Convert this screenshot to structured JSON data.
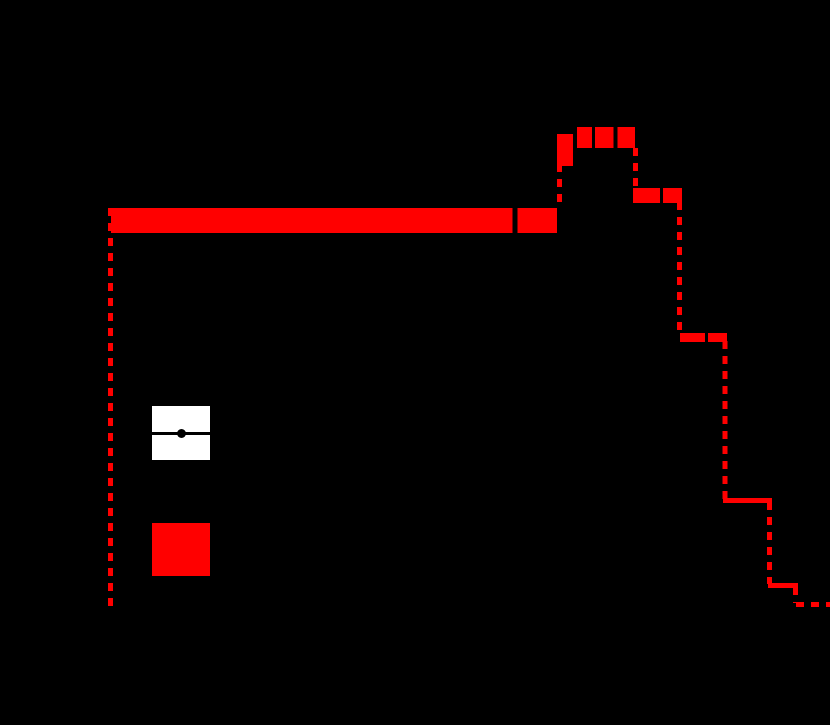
{
  "canvas": {
    "width_px": 830,
    "height_px": 725,
    "background_color": "#000000"
  },
  "palette": {
    "histogram_red": "#ff0000",
    "legend_patch_white": "#ffffff",
    "marker_black": "#000000"
  },
  "chart_data": {
    "type": "step-histogram-with-uncertainty-band",
    "title": "",
    "axes_visible": false,
    "tick_labels_visible": false,
    "legend_text_visible": false,
    "bin_edges_px": [
      110.5,
      557.5,
      577,
      635.5,
      679.5,
      725,
      769.5,
      795.5,
      832
    ],
    "bin_value_y_px": [
      220.5,
      150,
      137.5,
      195.5,
      337.5,
      500.5,
      585.5,
      604.5
    ],
    "baseline_y_px": 612,
    "values_norm": [
      0.83,
      0.97,
      1.0,
      0.88,
      0.58,
      0.24,
      0.06,
      0.02
    ],
    "line_width_px": 5,
    "dash_pattern_px": [
      8,
      7
    ],
    "band_rects_px": [
      {
        "x": 111,
        "y": 208,
        "w": 446,
        "h": 25
      },
      {
        "x": 557,
        "y": 134,
        "w": 20,
        "h": 32
      },
      {
        "x": 577,
        "y": 127,
        "w": 58,
        "h": 21
      },
      {
        "x": 633,
        "y": 188,
        "w": 49,
        "h": 15
      },
      {
        "x": 680,
        "y": 333,
        "w": 47,
        "h": 9
      },
      {
        "x": 723,
        "y": 498,
        "w": 49,
        "h": 5
      },
      {
        "x": 768,
        "y": 583,
        "w": 30,
        "h": 5
      }
    ],
    "dashed_segments_px": [
      {
        "x1": 110.5,
        "y1": 208,
        "x2": 110.5,
        "y2": 612
      },
      {
        "x1": 559.5,
        "y1": 134,
        "x2": 559.5,
        "y2": 208
      },
      {
        "x1": 635.5,
        "y1": 148,
        "x2": 635.5,
        "y2": 190
      },
      {
        "x1": 679.5,
        "y1": 202,
        "x2": 679.5,
        "y2": 334
      },
      {
        "x1": 725,
        "y1": 341,
        "x2": 725,
        "y2": 499
      },
      {
        "x1": 769.5,
        "y1": 502,
        "x2": 769.5,
        "y2": 584
      },
      {
        "x1": 795.5,
        "y1": 587,
        "x2": 795.5,
        "y2": 603
      },
      {
        "x1": 796,
        "y1": 604.5,
        "x2": 832,
        "y2": 604.5
      }
    ],
    "data_marker_cuts_px": [
      {
        "x": 512.5,
        "y": 208,
        "w": 5,
        "h": 25
      },
      {
        "x": 573,
        "y": 134,
        "w": 4,
        "h": 32
      },
      {
        "x": 592,
        "y": 127,
        "w": 3,
        "h": 21
      },
      {
        "x": 613.5,
        "y": 127,
        "w": 4,
        "h": 21
      },
      {
        "x": 660,
        "y": 188,
        "w": 3,
        "h": 15
      },
      {
        "x": 705,
        "y": 333,
        "w": 3,
        "h": 9
      }
    ]
  },
  "legend": {
    "entries": [
      {
        "id": "data-points",
        "swatch": "white-box-with-black-errorbar-and-dot",
        "x": 152,
        "y": 406,
        "w": 58,
        "h": 54,
        "errbar_y_frac": 0.5,
        "errbar_h": 3,
        "dot_d": 9
      },
      {
        "id": "uncertainty-band",
        "swatch": "red-filled-box",
        "x": 152,
        "y": 523,
        "w": 58,
        "h": 53
      }
    ]
  }
}
